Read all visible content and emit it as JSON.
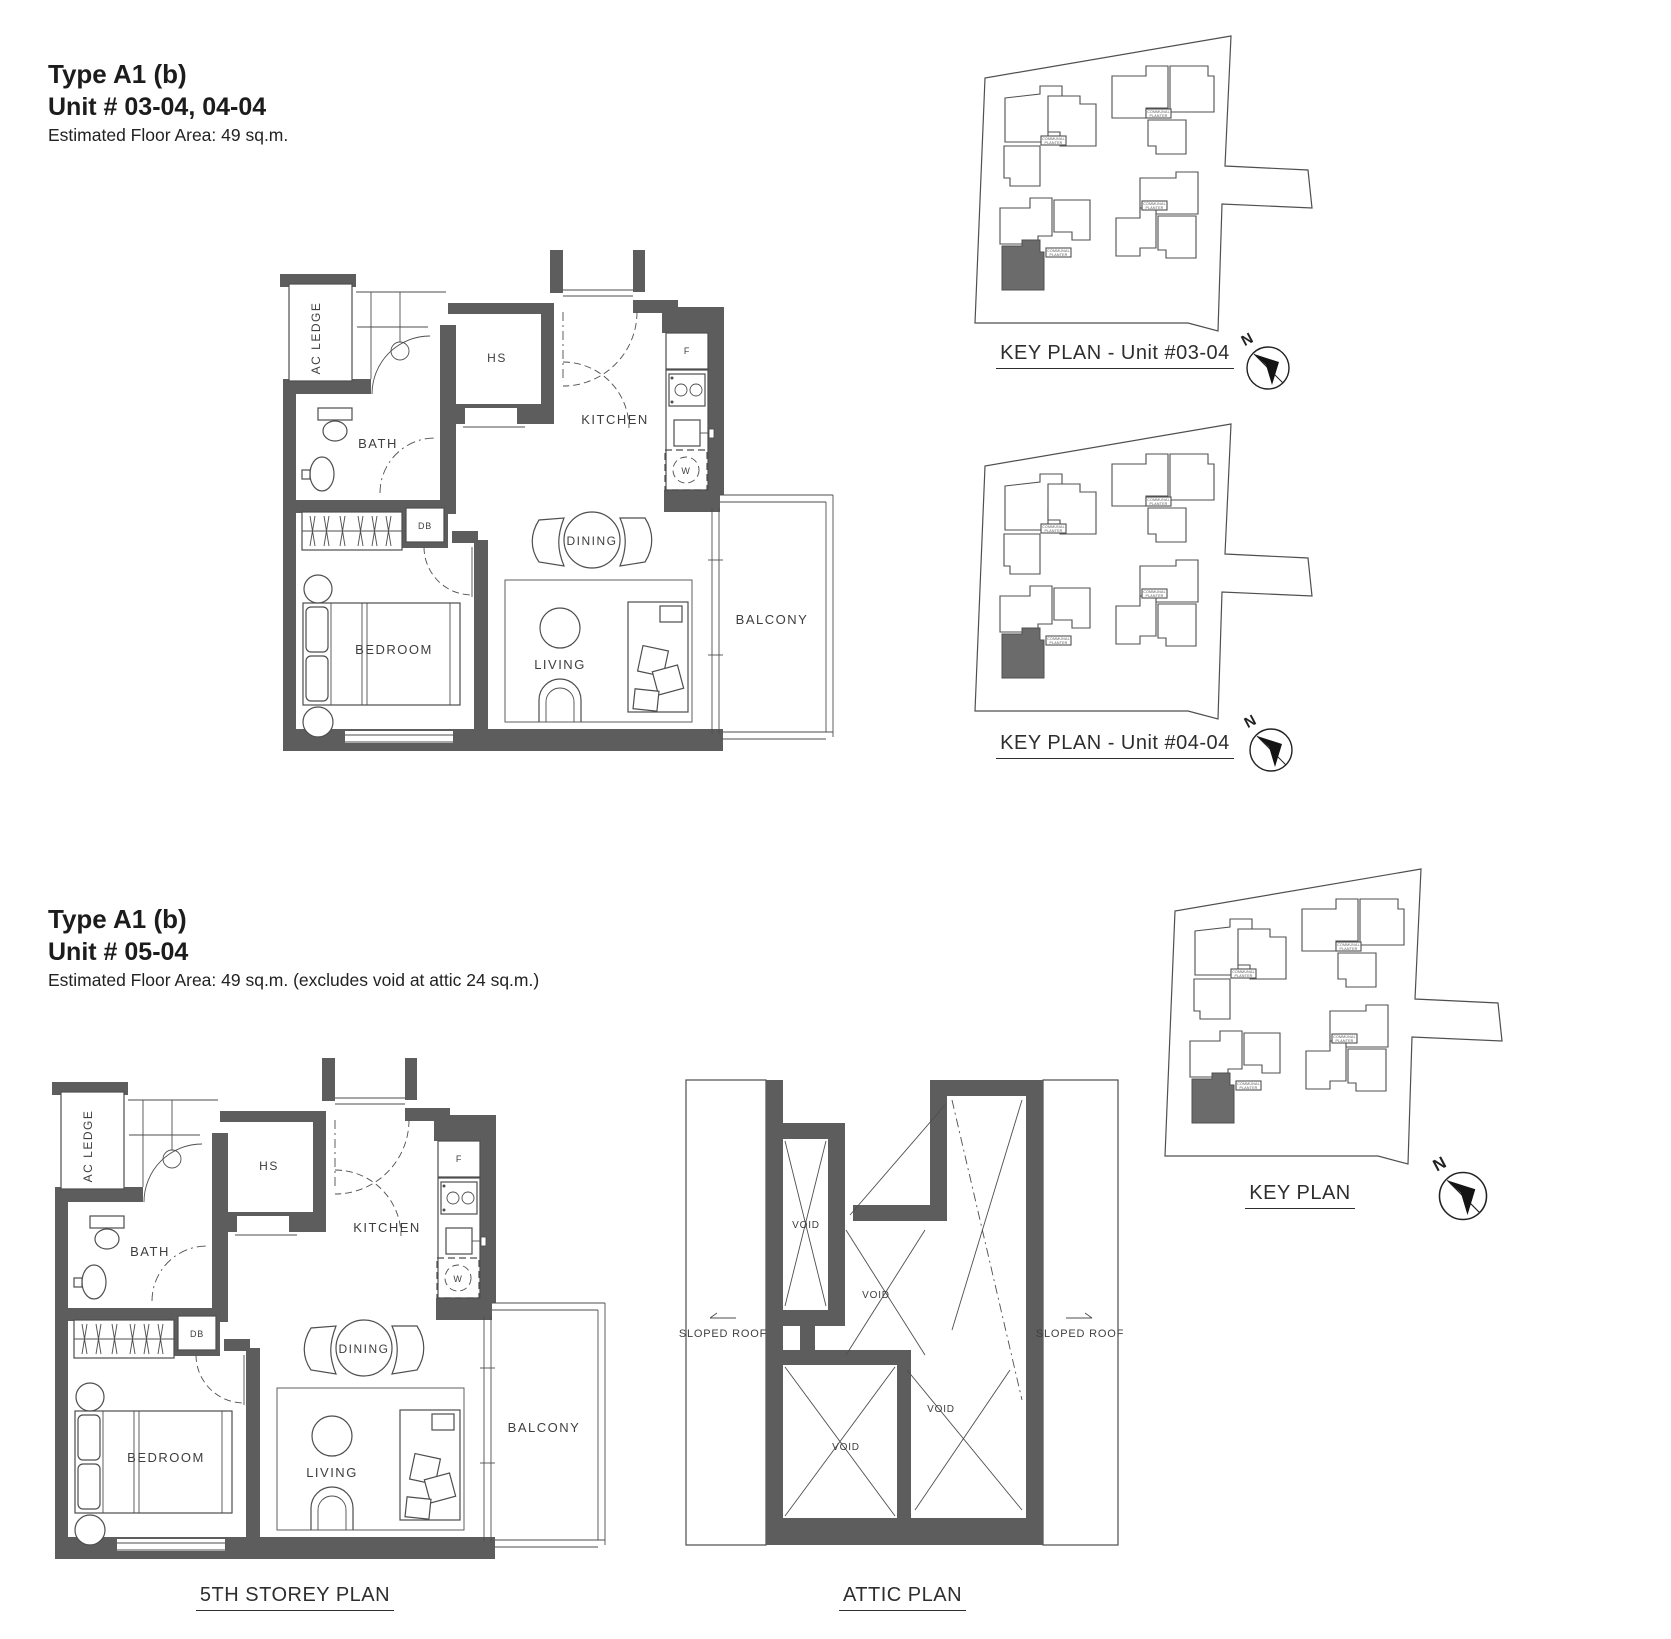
{
  "colors": {
    "wall": "#5d5d5d",
    "line": "#4e4e4e",
    "text": "#3e3e3e",
    "highlight": "#6b6b6b"
  },
  "section_top": {
    "type_title": "Type A1 (b)",
    "unit_title": "Unit # 03-04, 04-04",
    "floor_area": "Estimated Floor Area: 49 sq.m.",
    "keyplan_03_caption": "KEY PLAN - Unit #03-04",
    "keyplan_04_caption": "KEY PLAN - Unit #04-04"
  },
  "section_bottom": {
    "type_title": "Type A1 (b)",
    "unit_title": "Unit # 05-04",
    "floor_area": "Estimated Floor Area: 49 sq.m. (excludes void at attic 24 sq.m.)",
    "storey_caption": "5TH STOREY PLAN",
    "attic_caption": "ATTIC PLAN",
    "keyplan_caption": "KEY PLAN"
  },
  "rooms": {
    "ac_ledge": "AC LEDGE",
    "bath": "BATH",
    "hs": "HS",
    "kitchen": "KITCHEN",
    "dining": "DINING",
    "bedroom": "BEDROOM",
    "living": "LIVING",
    "balcony": "BALCONY",
    "db": "DB",
    "fridge": "F",
    "washer": "W"
  },
  "attic": {
    "void": "VOID",
    "sloped_roof": "SLOPED ROOF"
  },
  "keyplan": {
    "communal_line1": "COMMUNAL",
    "communal_line2": "PLANTER",
    "north": "N"
  }
}
